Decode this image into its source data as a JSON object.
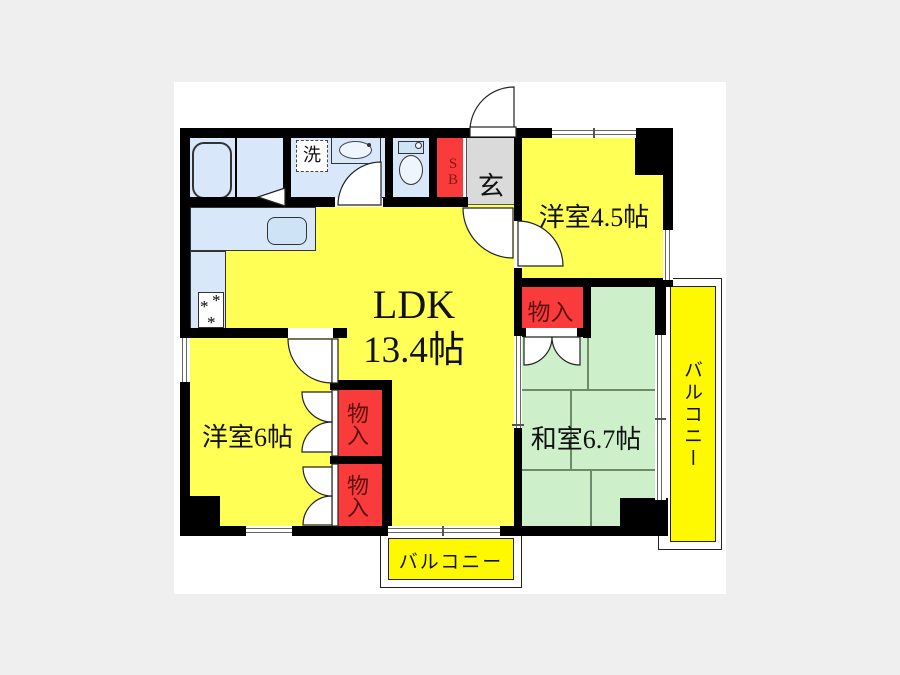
{
  "floorplan": {
    "ldk": {
      "name": "LDK",
      "size": "13.4帖"
    },
    "rooms": {
      "western_4_5": "洋室4.5帖",
      "western_6": "洋室6帖",
      "japanese": "和室6.7帖"
    },
    "closets": [
      "物入",
      "物入",
      "物入"
    ],
    "balconies": {
      "right": "バルコニー",
      "bottom": "バルコニー"
    },
    "entrance": "玄",
    "shoe_box": "SB",
    "laundry": "洗",
    "colors": {
      "room_yellow": "#ffff55",
      "balcony_yellow": "#fef900",
      "tatami_green": "#cdf0cb",
      "closet_red": "#f93b3b",
      "water_blue": "#d8e8fa",
      "entrance_gray": "#dadada",
      "wall_black": "#000000"
    }
  }
}
